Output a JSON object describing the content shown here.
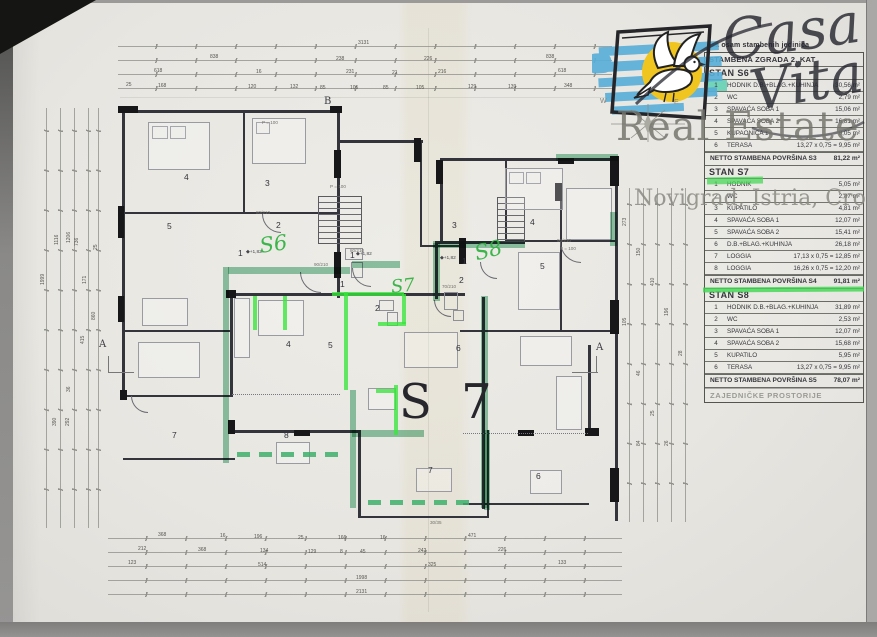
{
  "colors": {
    "highlight_lime": "#3ae03c",
    "highlight_teal": "#3aa26c",
    "hand_green": "#2eb13e",
    "logo_blue": "#57aed8",
    "logo_yellow": "#f1c51f",
    "paper": "#e8e6e1"
  },
  "logo": {
    "casa": "Casa",
    "vita": "Vita",
    "real_estate": "Real Estate",
    "location": "Novigrad, Istria, Croatia",
    "compass_w": "W",
    "compass_e": "E"
  },
  "table": {
    "pre_title": "sa osam stambenih jedinica",
    "title": "STAMBENA ZGRADA 2. KAT",
    "sections": [
      {
        "name": "STAN S6",
        "rows": [
          {
            "n": "1",
            "l": "HODNIK D.B.+BLAG.+KUHINJA",
            "v": "30,56 m²",
            "hl": "num"
          },
          {
            "n": "2",
            "l": "WC",
            "v": "2,79 m²"
          },
          {
            "n": "3",
            "l": "SPAVAĆA SOBA 1",
            "v": "15,06 m²"
          },
          {
            "n": "4",
            "l": "SPAVAĆA SOBA 2",
            "v": "16,81 m²"
          },
          {
            "n": "5",
            "l": "KUPAONICA 1",
            "v": "6,05 m²"
          },
          {
            "n": "6",
            "l": "TERASA",
            "v": "13,27 x 0,75 = 9,95 m²"
          }
        ],
        "total_label": "NETTO STAMBENA POVRŠINA S3",
        "total_value": "81,22 m²"
      },
      {
        "name": "STAN S7",
        "rows": [
          {
            "n": "1",
            "l": "HODNIK",
            "v": "5,05 m²",
            "hl": "bar"
          },
          {
            "n": "2",
            "l": "WC",
            "v": "2,87 m²"
          },
          {
            "n": "3",
            "l": "KUPATILO",
            "v": "4,81 m²"
          },
          {
            "n": "4",
            "l": "SPAVAĆA SOBA 1",
            "v": "12,07 m²"
          },
          {
            "n": "5",
            "l": "SPAVAĆA SOBA 2",
            "v": "15,41 m²"
          },
          {
            "n": "6",
            "l": "D.B.+BLAG.+KUHINJA",
            "v": "26,18 m²"
          },
          {
            "n": "7",
            "l": "LOGGIA",
            "v": "17,13 x 0,75 = 12,85 m²"
          },
          {
            "n": "8",
            "l": "LOGGIA",
            "v": "16,26 x 0,75 = 12,20 m²"
          }
        ],
        "total_label": "NETTO STAMBENA POVRŠINA S4",
        "total_value": "91,81 m²",
        "mark": "underline"
      },
      {
        "name": "STAN S8",
        "rows": [
          {
            "n": "1",
            "l": "HODNIK D.B.+BLAG.+KUHINJA",
            "v": "31,89 m²"
          },
          {
            "n": "2",
            "l": "WC",
            "v": "2,53 m²"
          },
          {
            "n": "3",
            "l": "SPAVAĆA SOBA 1",
            "v": "12,07 m²"
          },
          {
            "n": "4",
            "l": "SPAVAĆA SOBA 2",
            "v": "15,68 m²"
          },
          {
            "n": "5",
            "l": "KUPATILO",
            "v": "5,95 m²"
          },
          {
            "n": "6",
            "l": "TERASA",
            "v": "13,27 x 0,75 = 9,95 m²"
          }
        ],
        "total_label": "NETTO STAMBENA POVRŠINA S5",
        "total_value": "78,07 m²"
      }
    ],
    "footer": "ZAJEDNIČKE PROSTORIJE"
  },
  "plan": {
    "big_label": "S 7",
    "handwritten": [
      {
        "t": "S6",
        "x": 258,
        "y": 234,
        "fs": 21,
        "r": -8
      },
      {
        "t": "S7",
        "x": 390,
        "y": 277,
        "fs": 18,
        "r": -6
      },
      {
        "t": "S8",
        "x": 472,
        "y": 242,
        "fs": 21,
        "r": -14
      }
    ],
    "room_numbers": [
      {
        "t": "4",
        "x": 184,
        "y": 172
      },
      {
        "t": "3",
        "x": 265,
        "y": 178
      },
      {
        "t": "5",
        "x": 167,
        "y": 221
      },
      {
        "t": "2",
        "x": 276,
        "y": 220
      },
      {
        "t": "1",
        "x": 238,
        "y": 248
      },
      {
        "t": "1",
        "x": 350,
        "y": 250
      },
      {
        "t": "1",
        "x": 340,
        "y": 279
      },
      {
        "t": "2",
        "x": 375,
        "y": 303
      },
      {
        "t": "2",
        "x": 459,
        "y": 275
      },
      {
        "t": "3",
        "x": 452,
        "y": 220
      },
      {
        "t": "4",
        "x": 530,
        "y": 217
      },
      {
        "t": "5",
        "x": 540,
        "y": 261
      },
      {
        "t": "1",
        "x": 462,
        "y": 256
      },
      {
        "t": "4",
        "x": 286,
        "y": 339
      },
      {
        "t": "5",
        "x": 328,
        "y": 340
      },
      {
        "t": "6",
        "x": 456,
        "y": 343
      },
      {
        "t": "7",
        "x": 172,
        "y": 430
      },
      {
        "t": "8",
        "x": 284,
        "y": 430
      },
      {
        "t": "7",
        "x": 428,
        "y": 465
      },
      {
        "t": "6",
        "x": 536,
        "y": 471
      }
    ],
    "markers": [
      {
        "t": "A",
        "x": 99,
        "y": 339
      },
      {
        "t": "A",
        "x": 596,
        "y": 342
      },
      {
        "t": "B",
        "x": 324,
        "y": 96
      }
    ],
    "levels": [
      {
        "t": "◆+1,82",
        "x": 246,
        "y": 250
      },
      {
        "t": "◆+1,82",
        "x": 356,
        "y": 252
      },
      {
        "t": "◆+1,82",
        "x": 440,
        "y": 256
      }
    ],
    "plan_texts": [
      {
        "t": "P = 100",
        "x": 262,
        "y": 120
      },
      {
        "t": "P = 100",
        "x": 330,
        "y": 184
      },
      {
        "t": "P = 100",
        "x": 560,
        "y": 246
      },
      {
        "t": "90/210",
        "x": 314,
        "y": 262
      },
      {
        "t": "80/210",
        "x": 350,
        "y": 248
      },
      {
        "t": "70/210",
        "x": 442,
        "y": 284
      },
      {
        "t": "80/210",
        "x": 256,
        "y": 210
      },
      {
        "t": "90/210",
        "x": 557,
        "y": 238
      },
      {
        "t": "30/35",
        "x": 430,
        "y": 520
      }
    ],
    "dims": [
      {
        "t": "3131",
        "x": 358,
        "y": 40
      },
      {
        "t": "838",
        "x": 210,
        "y": 54
      },
      {
        "t": "238",
        "x": 336,
        "y": 56
      },
      {
        "t": "226",
        "x": 424,
        "y": 56
      },
      {
        "t": "838",
        "x": 546,
        "y": 54
      },
      {
        "t": "618",
        "x": 154,
        "y": 68
      },
      {
        "t": "16",
        "x": 256,
        "y": 69
      },
      {
        "t": "231",
        "x": 346,
        "y": 69
      },
      {
        "t": "21",
        "x": 392,
        "y": 70
      },
      {
        "t": "216",
        "x": 438,
        "y": 69
      },
      {
        "t": "618",
        "x": 558,
        "y": 68
      },
      {
        "t": "25",
        "x": 126,
        "y": 82
      },
      {
        "t": "168",
        "x": 158,
        "y": 83
      },
      {
        "t": "120",
        "x": 248,
        "y": 84
      },
      {
        "t": "132",
        "x": 290,
        "y": 84
      },
      {
        "t": "85",
        "x": 320,
        "y": 85
      },
      {
        "t": "105",
        "x": 350,
        "y": 85
      },
      {
        "t": "85",
        "x": 383,
        "y": 85
      },
      {
        "t": "105",
        "x": 416,
        "y": 85
      },
      {
        "t": "129",
        "x": 468,
        "y": 84
      },
      {
        "t": "139",
        "x": 508,
        "y": 84
      },
      {
        "t": "348",
        "x": 564,
        "y": 83
      },
      {
        "t": "368",
        "x": 158,
        "y": 532
      },
      {
        "t": "16",
        "x": 220,
        "y": 533
      },
      {
        "t": "196",
        "x": 254,
        "y": 534
      },
      {
        "t": "25",
        "x": 298,
        "y": 535
      },
      {
        "t": "166",
        "x": 338,
        "y": 535
      },
      {
        "t": "16",
        "x": 380,
        "y": 535
      },
      {
        "t": "471",
        "x": 468,
        "y": 533
      },
      {
        "t": "212",
        "x": 138,
        "y": 546
      },
      {
        "t": "368",
        "x": 198,
        "y": 547
      },
      {
        "t": "134",
        "x": 260,
        "y": 548
      },
      {
        "t": "129",
        "x": 308,
        "y": 549
      },
      {
        "t": "8",
        "x": 340,
        "y": 549
      },
      {
        "t": "45",
        "x": 360,
        "y": 549
      },
      {
        "t": "242",
        "x": 418,
        "y": 548
      },
      {
        "t": "226",
        "x": 498,
        "y": 547
      },
      {
        "t": "123",
        "x": 128,
        "y": 560
      },
      {
        "t": "514",
        "x": 258,
        "y": 562
      },
      {
        "t": "325",
        "x": 428,
        "y": 562
      },
      {
        "t": "133",
        "x": 558,
        "y": 560
      },
      {
        "t": "1998",
        "x": 356,
        "y": 575
      },
      {
        "t": "2131",
        "x": 356,
        "y": 589
      },
      {
        "t": "1999",
        "x": 40,
        "y": 285,
        "r": -90
      },
      {
        "t": "1116",
        "x": 54,
        "y": 245,
        "r": -90
      },
      {
        "t": "1206",
        "x": 66,
        "y": 243,
        "r": -90
      },
      {
        "t": "736",
        "x": 74,
        "y": 246,
        "r": -90
      },
      {
        "t": "25",
        "x": 93,
        "y": 250,
        "r": -90
      },
      {
        "t": "171",
        "x": 82,
        "y": 284,
        "r": -90
      },
      {
        "t": "860",
        "x": 91,
        "y": 320,
        "r": -90
      },
      {
        "t": "415",
        "x": 80,
        "y": 344,
        "r": -90
      },
      {
        "t": "36",
        "x": 66,
        "y": 392,
        "r": -90
      },
      {
        "t": "390",
        "x": 52,
        "y": 426,
        "r": -90
      },
      {
        "t": "292",
        "x": 65,
        "y": 426,
        "r": -90
      },
      {
        "t": "273",
        "x": 622,
        "y": 226,
        "r": -90
      },
      {
        "t": "105",
        "x": 622,
        "y": 326,
        "r": -90
      },
      {
        "t": "150",
        "x": 636,
        "y": 256,
        "r": -90
      },
      {
        "t": "46",
        "x": 636,
        "y": 376,
        "r": -90
      },
      {
        "t": "410",
        "x": 650,
        "y": 286,
        "r": -90
      },
      {
        "t": "25",
        "x": 650,
        "y": 416,
        "r": -90
      },
      {
        "t": "196",
        "x": 664,
        "y": 316,
        "r": -90
      },
      {
        "t": "28",
        "x": 678,
        "y": 356,
        "r": -90
      },
      {
        "t": "84",
        "x": 636,
        "y": 446,
        "r": -90
      },
      {
        "t": "26",
        "x": 664,
        "y": 446,
        "r": -90
      }
    ]
  }
}
